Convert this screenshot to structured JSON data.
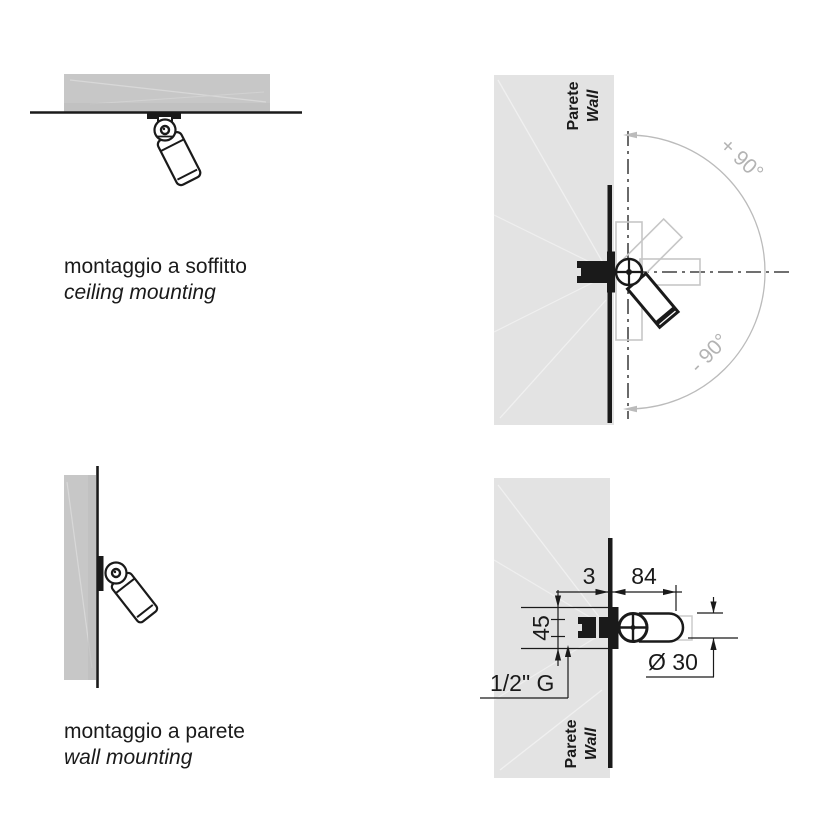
{
  "colors": {
    "background": "#ffffff",
    "slab_gray": "#c7c7c7",
    "wall_gray": "#e3e3e3",
    "line_black": "#1a1a1a",
    "ghost_gray": "#c6c6c6",
    "arc_gray": "#bbbbbb",
    "angle_text_gray": "#b3b3b3"
  },
  "ceiling_section": {
    "caption_line1": "montaggio a soffitto",
    "caption_line2": "ceiling mounting"
  },
  "wall_section": {
    "caption_line1": "montaggio a parete",
    "caption_line2": "wall mounting"
  },
  "rotation_diagram": {
    "wall_label_it": "Parete",
    "wall_label_en": "Wall",
    "angle_plus": "+ 90°",
    "angle_minus": "- 90°"
  },
  "dimension_diagram": {
    "wall_label_it": "Parete",
    "wall_label_en": "Wall",
    "dim_offset": "3",
    "dim_length": "84",
    "dim_height": "45",
    "dim_thread": "1/2\" G",
    "dim_diameter": "Ø 30"
  }
}
